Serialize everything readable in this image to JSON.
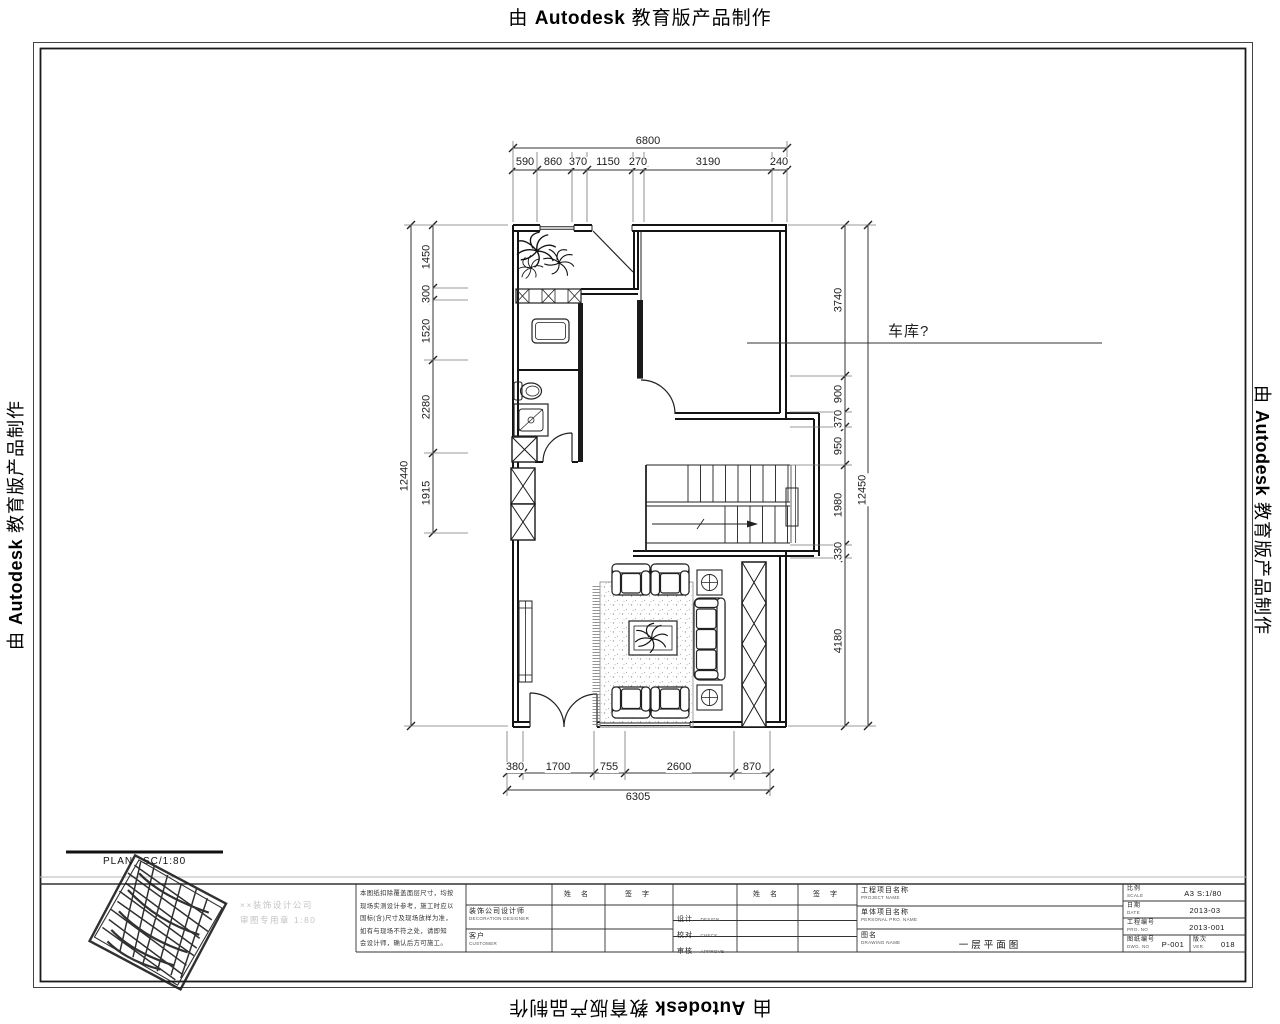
{
  "banner": {
    "prefix": "由",
    "brand": "Autodesk",
    "suffix": "教育版产品制作"
  },
  "plan": {
    "garage_label": "车库?",
    "plan_label": "PLAN",
    "plan_scale": "SC/1:80"
  },
  "dims": {
    "top_total": "6800",
    "top": [
      "590",
      "860",
      "370",
      "1150",
      "270",
      "3190",
      "240"
    ],
    "left_total": "12440",
    "left": [
      "1450",
      "300",
      "1520",
      "2280",
      "1915"
    ],
    "right_total": "12450",
    "right": [
      "3740",
      "900",
      "370",
      "950",
      "1980",
      "330",
      "4180"
    ],
    "bottom": [
      "380",
      "1700",
      "755",
      "2600",
      "870"
    ],
    "bottom_total": "6305"
  },
  "titleblock": {
    "notes": [
      "本图纸扣除覆盖面层尺寸，均按",
      "现场实测设计参考，施工时应以",
      "国标(含)尺寸及现场放样为准，",
      "如有与现场不符之处，请即知",
      "会设计师，确认后方可施工。"
    ],
    "company_faint_1": "××装饰设计公司",
    "company_faint_2": "审图专用章 1:80",
    "designer_label": "装饰公司设计师",
    "designer_sub": "DECORATION DESIGNER",
    "client_label": "客户",
    "client_sub": "CUSTOMER",
    "name_header": "姓 名",
    "sign_header": "签 字",
    "design_label": "设计",
    "design_sub": "DESIGN",
    "check_label": "校对",
    "check_sub": "CHECK",
    "approve_label": "审核",
    "approve_sub": "APPROVE",
    "project_label": "工程项目名称",
    "project_sub": "PROJECT NAME",
    "unit_label": "单体项目名称",
    "unit_sub": "PERSONAL PRO. NAME",
    "dwgname_label": "图名",
    "dwgname_sub": "DRAWING NAME",
    "dwgname_value": "一层平面图",
    "scale_label": "比例",
    "scale_sub": "SCALE",
    "scale_value": "A3 S:1/80",
    "date_label": "日期",
    "date_sub": "DATE",
    "date_value": "2013-03",
    "projno_label": "工程编号",
    "projno_sub": "PRO. NO",
    "projno_value": "2013-001",
    "dwgno_label": "图纸编号",
    "dwgno_sub": "DWG. NO",
    "dwgno_value": "P-001",
    "ver_label": "版次",
    "ver_sub": "VER.",
    "ver_value": "018"
  }
}
